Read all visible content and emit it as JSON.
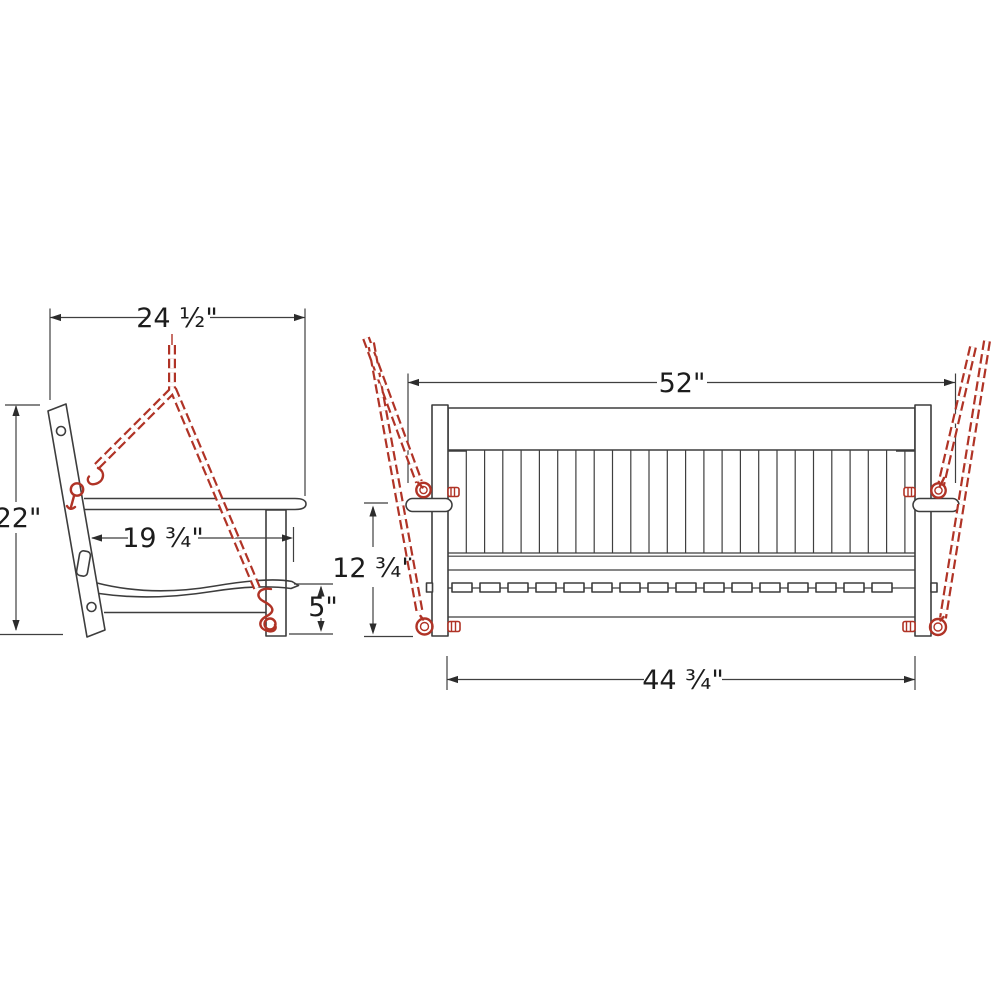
{
  "drawing": {
    "type": "furniture dimension drawing",
    "subject": "hanging porch swing with chains, side view and front view",
    "colors": {
      "chain": "#b03326",
      "outline": "#3d3d3d",
      "dimension": "#3f3f3f",
      "background": "#ffffff"
    }
  },
  "side_view": {
    "dims": {
      "width": "24 ½\"",
      "height": "22\"",
      "depth": "19 ¾\"",
      "clearance": "5\""
    }
  },
  "front_view": {
    "dims": {
      "width": "52\"",
      "height": "12 ¾\"",
      "seat_width": "44 ¾\""
    }
  }
}
